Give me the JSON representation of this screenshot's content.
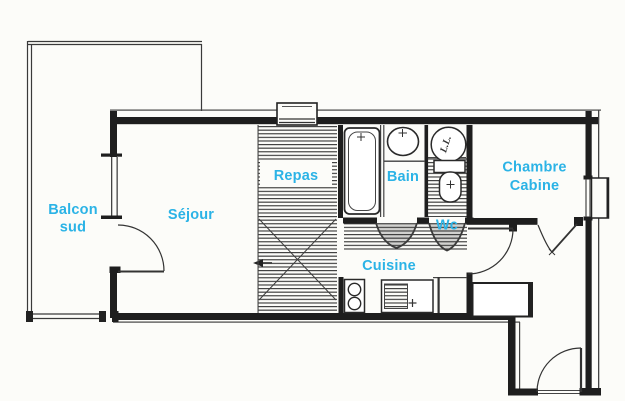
{
  "document": {
    "type": "scanned apartment floor plan",
    "background": "#fcfcf9"
  },
  "colors": {
    "label": "#2bb3e6",
    "wall": "#1e1e1e",
    "hatch": "#3c3c3c"
  },
  "labels": {
    "balcony_line1": "Balcon",
    "balcony_line2": "sud",
    "living": "Séjour",
    "dining": "Repas",
    "bath": "Bain",
    "wc": "Wc",
    "bedroom_line1": "Chambre",
    "bedroom_line2": "Cabine",
    "kitchen": "Cuisine",
    "washer": "L.L."
  }
}
